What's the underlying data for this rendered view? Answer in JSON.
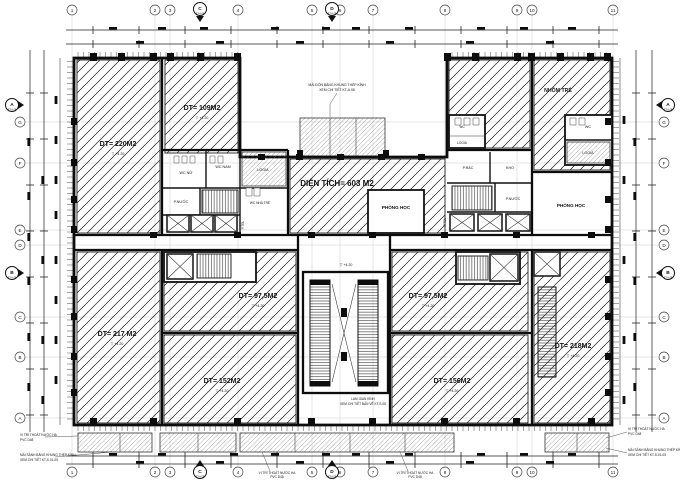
{
  "plan": {
    "level_mark": "▽ +4.20",
    "grid": {
      "cols": [
        "1",
        "2",
        "3",
        "4",
        "5",
        "6",
        "7",
        "8",
        "9",
        "10",
        "11"
      ],
      "rows": [
        "G",
        "F",
        "E",
        "D",
        "C",
        "B",
        "A"
      ],
      "sections": {
        "a": "A",
        "b": "B",
        "c": "C",
        "d": "D",
        "ref": "KT-A.08"
      }
    },
    "rooms": {
      "dt220": "DT= 220M2",
      "dt109": "DT= 109M2",
      "hall": "DIỆN TÍCH= 603 M2",
      "nhom_tre": "NHÓM TRẺ",
      "phong_hoc": "PHÒNG HỌC",
      "dt217": "DT= 217 M2",
      "dt97_5": "DT= 97,5M2",
      "dt152": "DT= 152M2",
      "dt156": "DT= 156M2",
      "dt218": "DT= 218M2",
      "wc_nu": "WC NỮ",
      "wc_nam": "WC NAM",
      "wc_nha_tre": "WC NHÀ TRẺ",
      "logia": "LOGIA",
      "p_nuoc": "P.NƯỚC",
      "p_tdl": "P.TĐL",
      "p_rac": "P.RÁC",
      "kho": "KHO",
      "wc": "WC"
    },
    "notes": {
      "canopy1": "MÁI ĐÓN BẰNG KHUNG THÉP KÍNH",
      "canopy2": "XEM CHI TIẾT KT-A.08",
      "drain1": "VỊ TRÍ THOÁT NƯỚC HA",
      "drain2": "PVC D48",
      "awning1": "MÁI SẢNH BẰNG KHUNG THÉP KÍNH",
      "awning2": "XEM CHI TIẾT KT-S.01-05",
      "lam1": "LAM GIAN KÍNH",
      "lam2": "XEM CHI TIẾT BẢN VẼ KT-S.08"
    }
  }
}
